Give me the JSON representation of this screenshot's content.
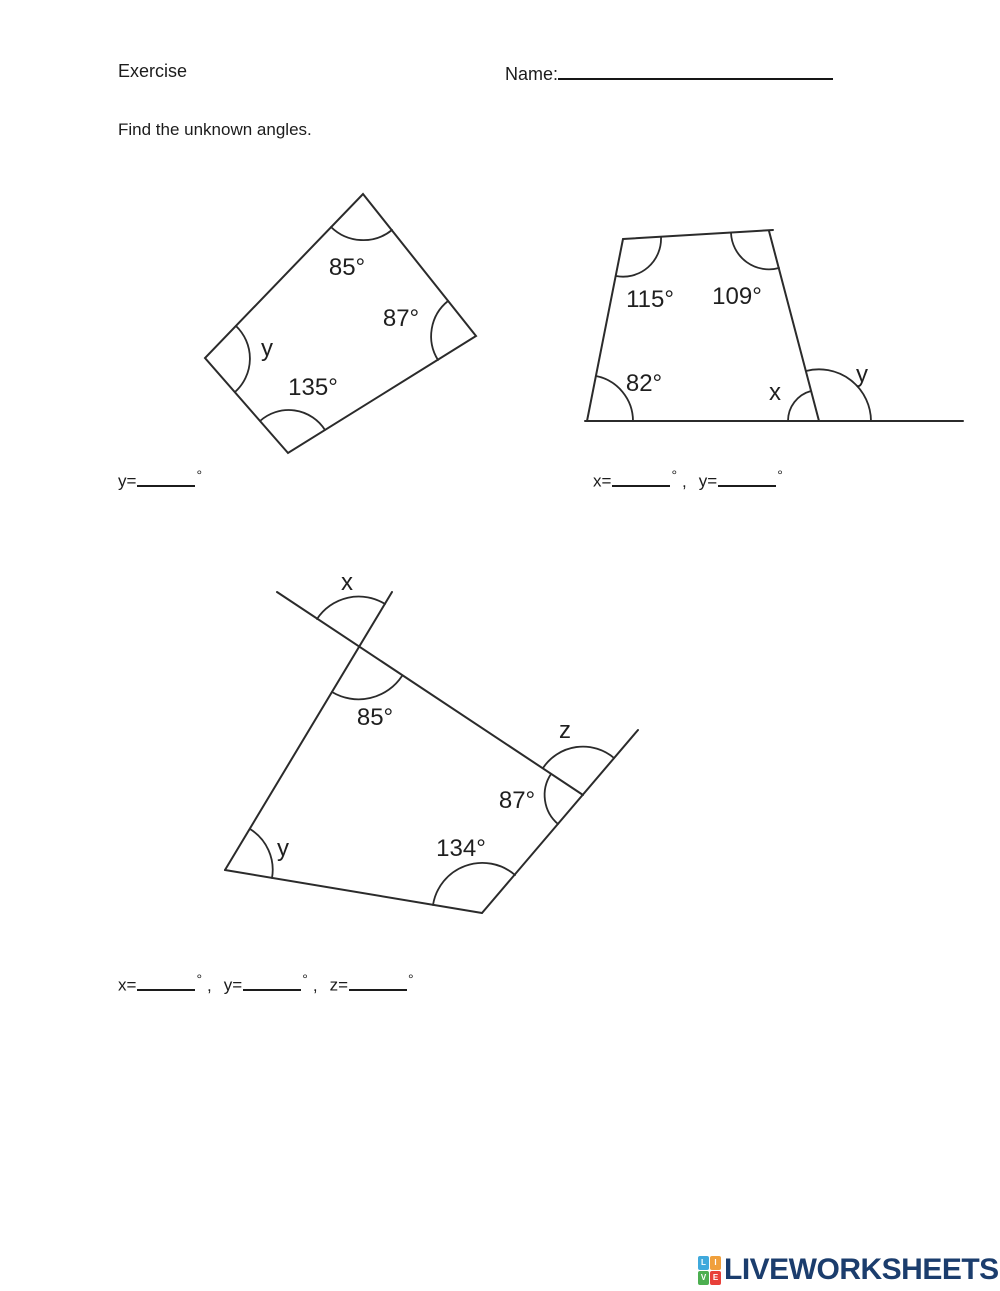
{
  "header": {
    "title": "Exercise",
    "name_label": "Name:"
  },
  "instruction": "Find the unknown angles.",
  "fig1": {
    "angle_top": "85°",
    "angle_right": "87°",
    "angle_left": "y",
    "angle_bottom": "135°"
  },
  "fig2": {
    "angle_top_left": "115°",
    "angle_top_right": "109°",
    "angle_bottom_left": "82°",
    "angle_x": "x",
    "angle_y": "y"
  },
  "fig3": {
    "angle_x": "x",
    "angle_85": "85°",
    "angle_z": "z",
    "angle_87": "87°",
    "angle_y": "y",
    "angle_134": "134°"
  },
  "answers": {
    "degree": "°",
    "comma": ",",
    "q1": {
      "y_prefix": "y="
    },
    "q2": {
      "x_prefix": "x=",
      "y_prefix": "y="
    },
    "q3": {
      "x_prefix": "x=",
      "y_prefix": "y=",
      "z_prefix": "z="
    }
  },
  "footer": {
    "brand": "LIVEWORKSHEETS",
    "brand_color": "#1b3d6d",
    "icon": {
      "letters": [
        "L",
        "I",
        "V",
        "E"
      ],
      "colors": [
        "#3fa9dc",
        "#f0a03c",
        "#4caf50",
        "#e8403a"
      ]
    }
  }
}
